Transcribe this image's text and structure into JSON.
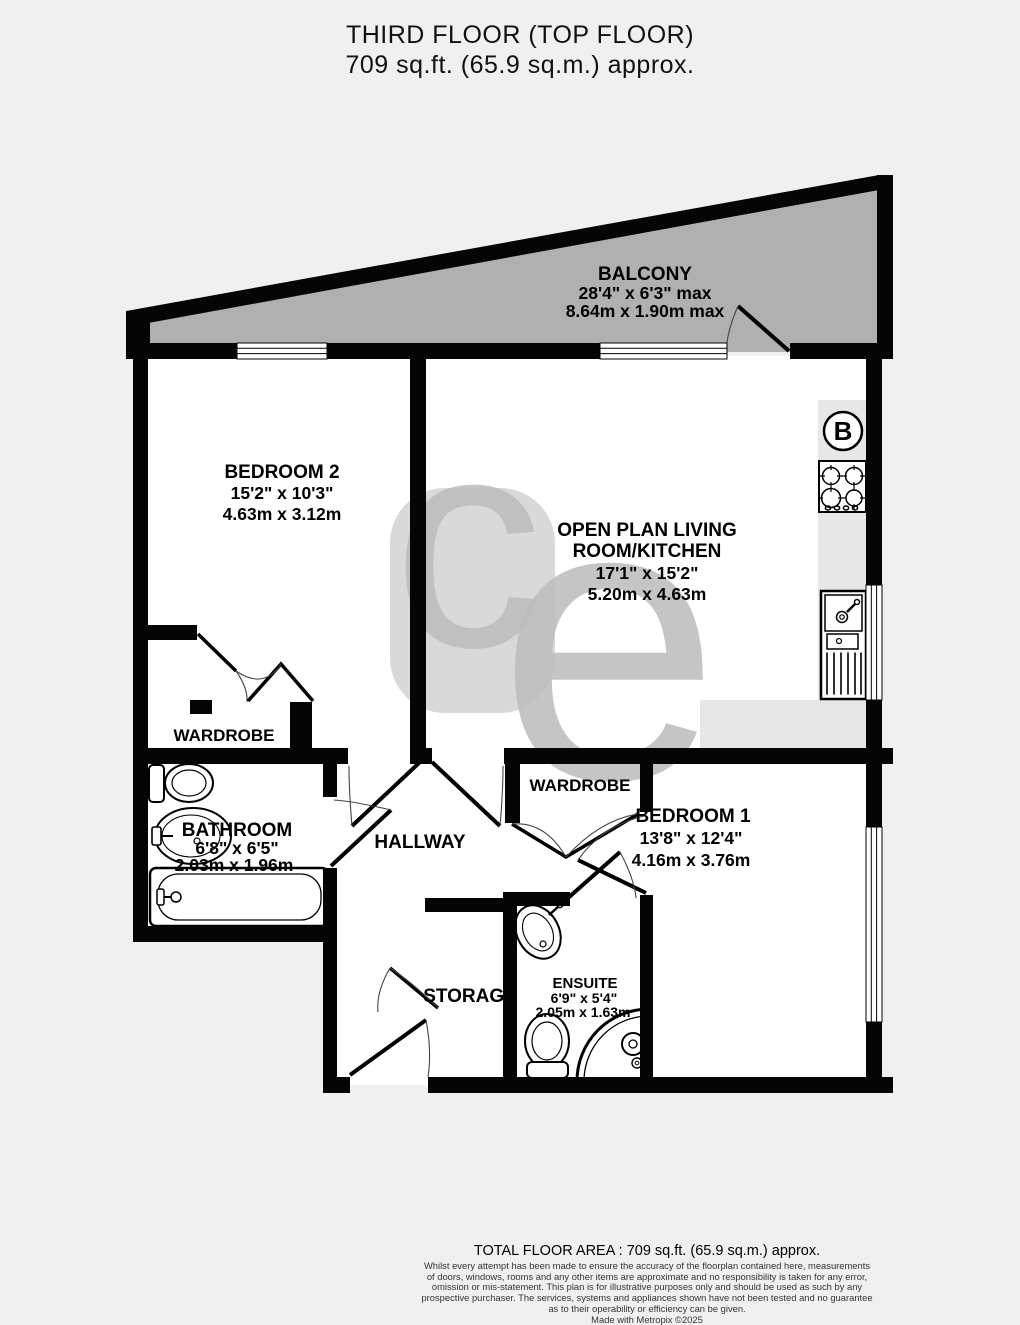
{
  "title": {
    "line1": "THIRD FLOOR (TOP FLOOR)",
    "line2": "709 sq.ft. (65.9 sq.m.) approx."
  },
  "rooms": {
    "balcony": {
      "name": "BALCONY",
      "imperial": "28'4\" x 6'3\" max",
      "metric": "8.64m x 1.90m max"
    },
    "bedroom2": {
      "name": "BEDROOM 2",
      "imperial": "15'2\" x 10'3\"",
      "metric": "4.63m x 3.12m"
    },
    "living": {
      "name_line1": "OPEN PLAN LIVING",
      "name_line2": "ROOM/KITCHEN",
      "imperial": "17'1\" x 15'2\"",
      "metric": "5.20m x 4.63m"
    },
    "wardrobe_left": {
      "name": "WARDROBE"
    },
    "bathroom": {
      "name": "BATHROOM",
      "imperial": "6'8\" x 6'5\"",
      "metric": "2.03m x 1.96m"
    },
    "hallway": {
      "name": "HALLWAY"
    },
    "wardrobe_right": {
      "name": "WARDROBE"
    },
    "bedroom1": {
      "name": "BEDROOM 1",
      "imperial": "13'8\" x 12'4\"",
      "metric": "4.16m x 3.76m"
    },
    "ensuite": {
      "name": "ENSUITE",
      "imperial": "6'9\" x 5'4\"",
      "metric": "2.05m x 1.63m"
    },
    "storage": {
      "name": "STORAGE"
    }
  },
  "annotations": {
    "boiler_label": "B",
    "watermark_c": "c",
    "watermark_e": "e"
  },
  "footer": {
    "total": "TOTAL FLOOR AREA : 709 sq.ft. (65.9 sq.m.) approx.",
    "disclaimer": [
      "Whilst every attempt has been made to ensure the accuracy of the floorplan contained here, measurements",
      "of doors, windows, rooms and any other items are approximate and no responsibility is taken for any error,",
      "omission or mis-statement. This plan is for illustrative purposes only and should be used as such by any",
      "prospective purchaser. The services, systems and appliances shown have not been tested and no guarantee",
      "as to their operability or efficiency can be given.",
      "Made with Metropix ©2025"
    ]
  },
  "colors": {
    "wall": "#000000",
    "balcony_fill": "#b0b0b0",
    "counter_fill": "#e7e7e7",
    "watermark": "#bcbcbc",
    "page_bg": "#f0f0f0"
  }
}
